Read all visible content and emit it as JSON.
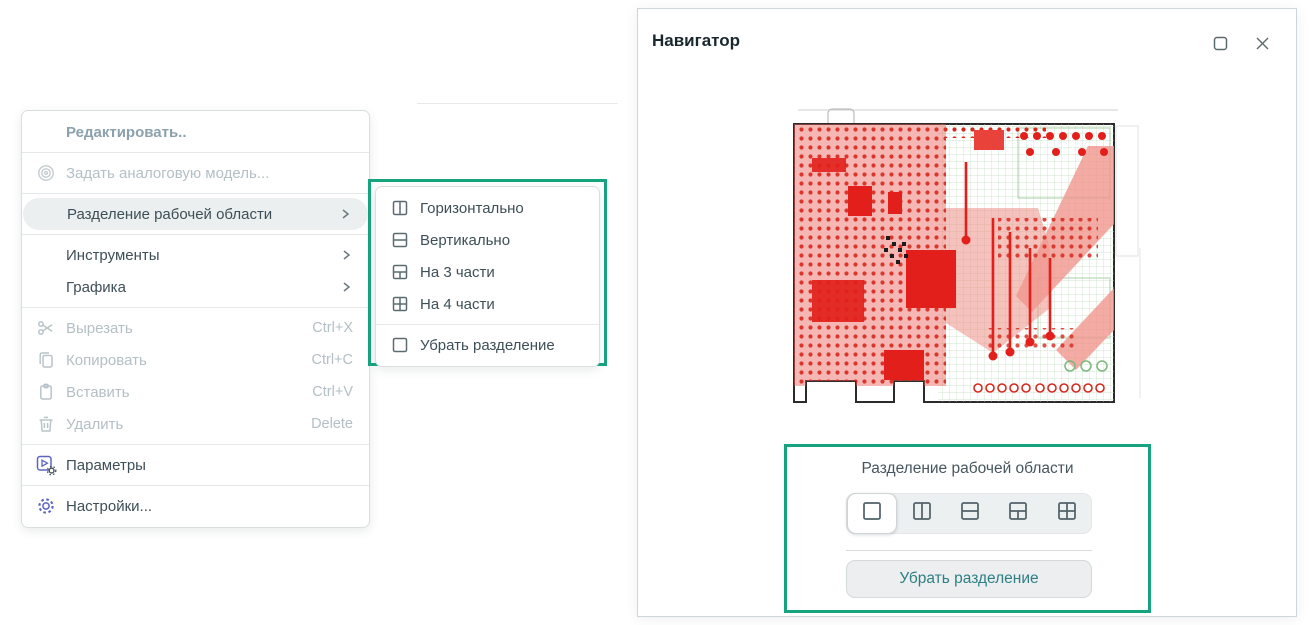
{
  "colors": {
    "annotation_green": "#16a47e",
    "accent_indigo": "#5b66c4",
    "disabled_gray": "#b3c0c6",
    "menu_text": "#3d4f57",
    "button_teal_text": "#2e7f84",
    "pcb_red": "#e21f1a",
    "pcb_green_trace": "#b7d8b5"
  },
  "context_menu": {
    "header": "Редактировать..",
    "items": [
      {
        "label": "Задать аналоговую модель...",
        "icon": "spiral-icon",
        "state": "disabled"
      },
      {
        "label": "Разделение рабочей области",
        "icon": "chevron-right-icon",
        "state": "highlighted",
        "has_submenu": true
      },
      {
        "label": "Инструменты",
        "icon": "chevron-right-icon",
        "has_submenu": true
      },
      {
        "label": "Графика",
        "icon": "chevron-right-icon",
        "has_submenu": true
      },
      {
        "label": "Вырезать",
        "shortcut": "Ctrl+X",
        "icon": "scissors-icon",
        "state": "disabled"
      },
      {
        "label": "Копировать",
        "shortcut": "Ctrl+C",
        "icon": "copy-icon",
        "state": "disabled"
      },
      {
        "label": "Вставить",
        "shortcut": "Ctrl+V",
        "icon": "clipboard-icon",
        "state": "disabled"
      },
      {
        "label": "Удалить",
        "shortcut": "Delete",
        "icon": "trash-icon",
        "state": "disabled"
      },
      {
        "label": "Параметры",
        "icon": "run-settings-icon"
      },
      {
        "label": "Настройки...",
        "icon": "gear-icon"
      }
    ]
  },
  "submenu": {
    "items": [
      {
        "label": "Горизонтально",
        "icon": "split-two-columns-icon"
      },
      {
        "label": "Вертикально",
        "icon": "split-two-rows-icon"
      },
      {
        "label": "На 3 части",
        "icon": "split-three-parts-icon"
      },
      {
        "label": "На 4 части",
        "icon": "split-four-parts-icon"
      },
      {
        "label": "Убрать разделение",
        "icon": "no-split-icon"
      }
    ]
  },
  "navigator": {
    "title": "Навигатор",
    "window_controls": [
      "maximize-icon",
      "close-icon"
    ],
    "preview": "pcb-layout-image",
    "section_label": "Разделение рабочей области",
    "split_options": [
      "no-split",
      "two-columns",
      "two-rows",
      "three-parts",
      "four-parts"
    ],
    "selected_split": "no-split",
    "remove_split_button": "Убрать разделение"
  }
}
